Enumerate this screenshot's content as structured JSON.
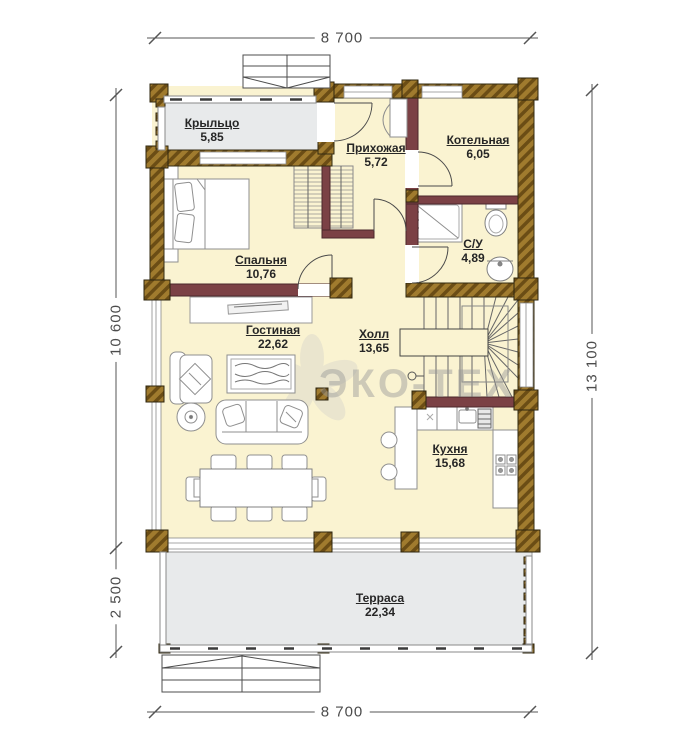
{
  "labels": {
    "porch": {
      "name": "Крыльцо",
      "area": "5,85"
    },
    "hallway": {
      "name": "Прихожая",
      "area": "5,72"
    },
    "boiler": {
      "name": "Котельная",
      "area": "6,05"
    },
    "bathroom": {
      "name": "С/У",
      "area": "4,89"
    },
    "bedroom": {
      "name": "Спальня",
      "area": "10,76"
    },
    "living": {
      "name": "Гостиная",
      "area": "22,62"
    },
    "hall": {
      "name": "Холл",
      "area": "13,65"
    },
    "kitchen": {
      "name": "Кухня",
      "area": "15,68"
    },
    "terrace": {
      "name": "Терраса",
      "area": "22,34"
    }
  },
  "dimensions": {
    "top": "8 700",
    "bottom": "8 700",
    "left_main": "10 600",
    "left_terrace": "2 500",
    "right": "13 100"
  },
  "watermark": "ЭКО-ТЕХ",
  "colors": {
    "room_fill": "#FAF3D1",
    "outdoor_fill": "#E8EAEB",
    "wood": "#A07B2E",
    "interior_wall": "#7B4145"
  }
}
